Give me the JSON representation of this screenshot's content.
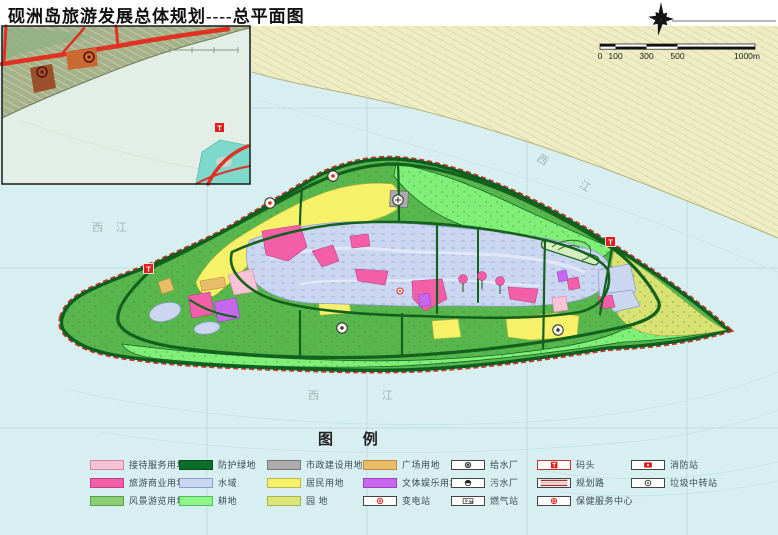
{
  "title": "砚洲岛旅游发展总体规划----总平面图",
  "scale_bar": {
    "labels": [
      "0",
      "100",
      "300",
      "500",
      "1000m"
    ]
  },
  "compass": {
    "type": "north-pinwheel-star"
  },
  "markers": {
    "wharf_text": "T"
  },
  "water_labels": [
    {
      "text": "西 江",
      "location": "north-channel"
    },
    {
      "text": "西 江",
      "location": "south-water"
    },
    {
      "text": "西 江",
      "location": "west-water"
    }
  ],
  "legend": {
    "title": "图 例",
    "items": [
      {
        "label": "接待服务用地",
        "kind": "fill",
        "color": "#F8C3D6",
        "border": "#D9849F"
      },
      {
        "label": "旅游商业用地",
        "kind": "fill",
        "color": "#F25FA8",
        "border": "#C43E86"
      },
      {
        "label": "风景游览用地",
        "kind": "fill",
        "color": "#8BCE74",
        "border": "#57A04A"
      },
      {
        "label": "防护绿地",
        "kind": "fill",
        "color": "#0A6E28",
        "border": "#064D1B"
      },
      {
        "label": "水域",
        "kind": "fill",
        "color": "#CBD7F1",
        "border": "#8E9CC9"
      },
      {
        "label": "耕地",
        "kind": "fill",
        "color": "#8DF58A",
        "border": "#52BD5B"
      },
      {
        "label": "市政建设用地",
        "kind": "fill",
        "color": "#ACACAC",
        "border": "#777777"
      },
      {
        "label": "居民用地",
        "kind": "fill",
        "color": "#F6F168",
        "border": "#BFB83E"
      },
      {
        "label": "园 地",
        "kind": "fill",
        "color": "#DCE77B",
        "border": "#A9B54B"
      },
      {
        "label": "广场用地",
        "kind": "fill",
        "color": "#E9BC69",
        "border": "#BB8C3C"
      },
      {
        "label": "文体娱乐用地",
        "kind": "fill",
        "color": "#C767EE",
        "border": "#9843BF"
      },
      {
        "label": "变电站",
        "kind": "symbol",
        "symbol": "substation"
      },
      {
        "label": "给水厂",
        "kind": "symbol",
        "symbol": "waterworks"
      },
      {
        "label": "污水厂",
        "kind": "symbol",
        "symbol": "sewage-plant"
      },
      {
        "label": "燃气站",
        "kind": "symbol",
        "symbol": "gas-station"
      },
      {
        "label": "码头",
        "kind": "symbol",
        "symbol": "wharf"
      },
      {
        "label": "规划路",
        "kind": "symbol",
        "symbol": "planned-road"
      },
      {
        "label": "保健服务中心",
        "kind": "symbol",
        "symbol": "health-service-center"
      },
      {
        "label": "消防站",
        "kind": "symbol",
        "symbol": "fire-station"
      },
      {
        "label": "垃圾中转站",
        "kind": "symbol",
        "symbol": "garbage-transfer-station"
      }
    ]
  },
  "palette": {
    "water": "#D8EFF2",
    "grid_line": "#AECBD2",
    "contour": "#BFE0E4",
    "mainland": "#EFEDC5",
    "shore": "#B4B07C",
    "island_green": "#57B74D",
    "farmland": "#7FEF78",
    "orchard": "#D8E272",
    "protect_green": "#0B5E20",
    "road_green": "#14611E",
    "coast_red": "#CC3A28",
    "water_area": "#CBD7F1",
    "water_border": "#8E9CC9",
    "residential": "#F6F168",
    "commerce": "#F25FA8",
    "service": "#F8C3D6",
    "culture": "#C767EE",
    "plaza": "#E9BC69",
    "municipal": "#ACACAC",
    "marker_red": "#DD1F1F",
    "inset_water": "#E3EFE6",
    "inset_land": "#A3B18C",
    "inset_teal": "#7FD8CC",
    "inset_road": "#E03122"
  }
}
